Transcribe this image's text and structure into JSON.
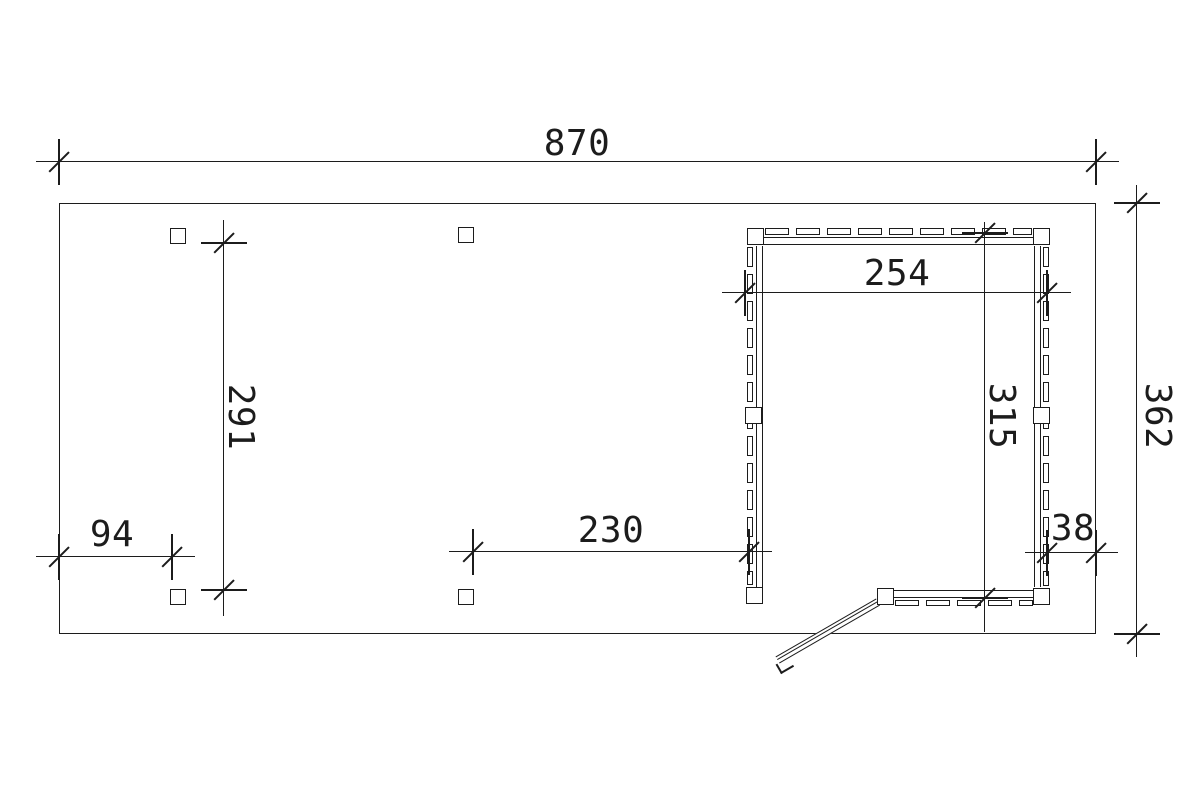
{
  "drawing": {
    "type": "floor-plan",
    "background": "#ffffff",
    "line_color": "#1c1c1c",
    "dims": {
      "overall_width": "870",
      "overall_depth": "362",
      "post_spacing_depth": "291",
      "left_bay_width": "94",
      "middle_bay_width": "230",
      "room_width": "254",
      "room_depth": "315",
      "right_gap": "38"
    }
  }
}
